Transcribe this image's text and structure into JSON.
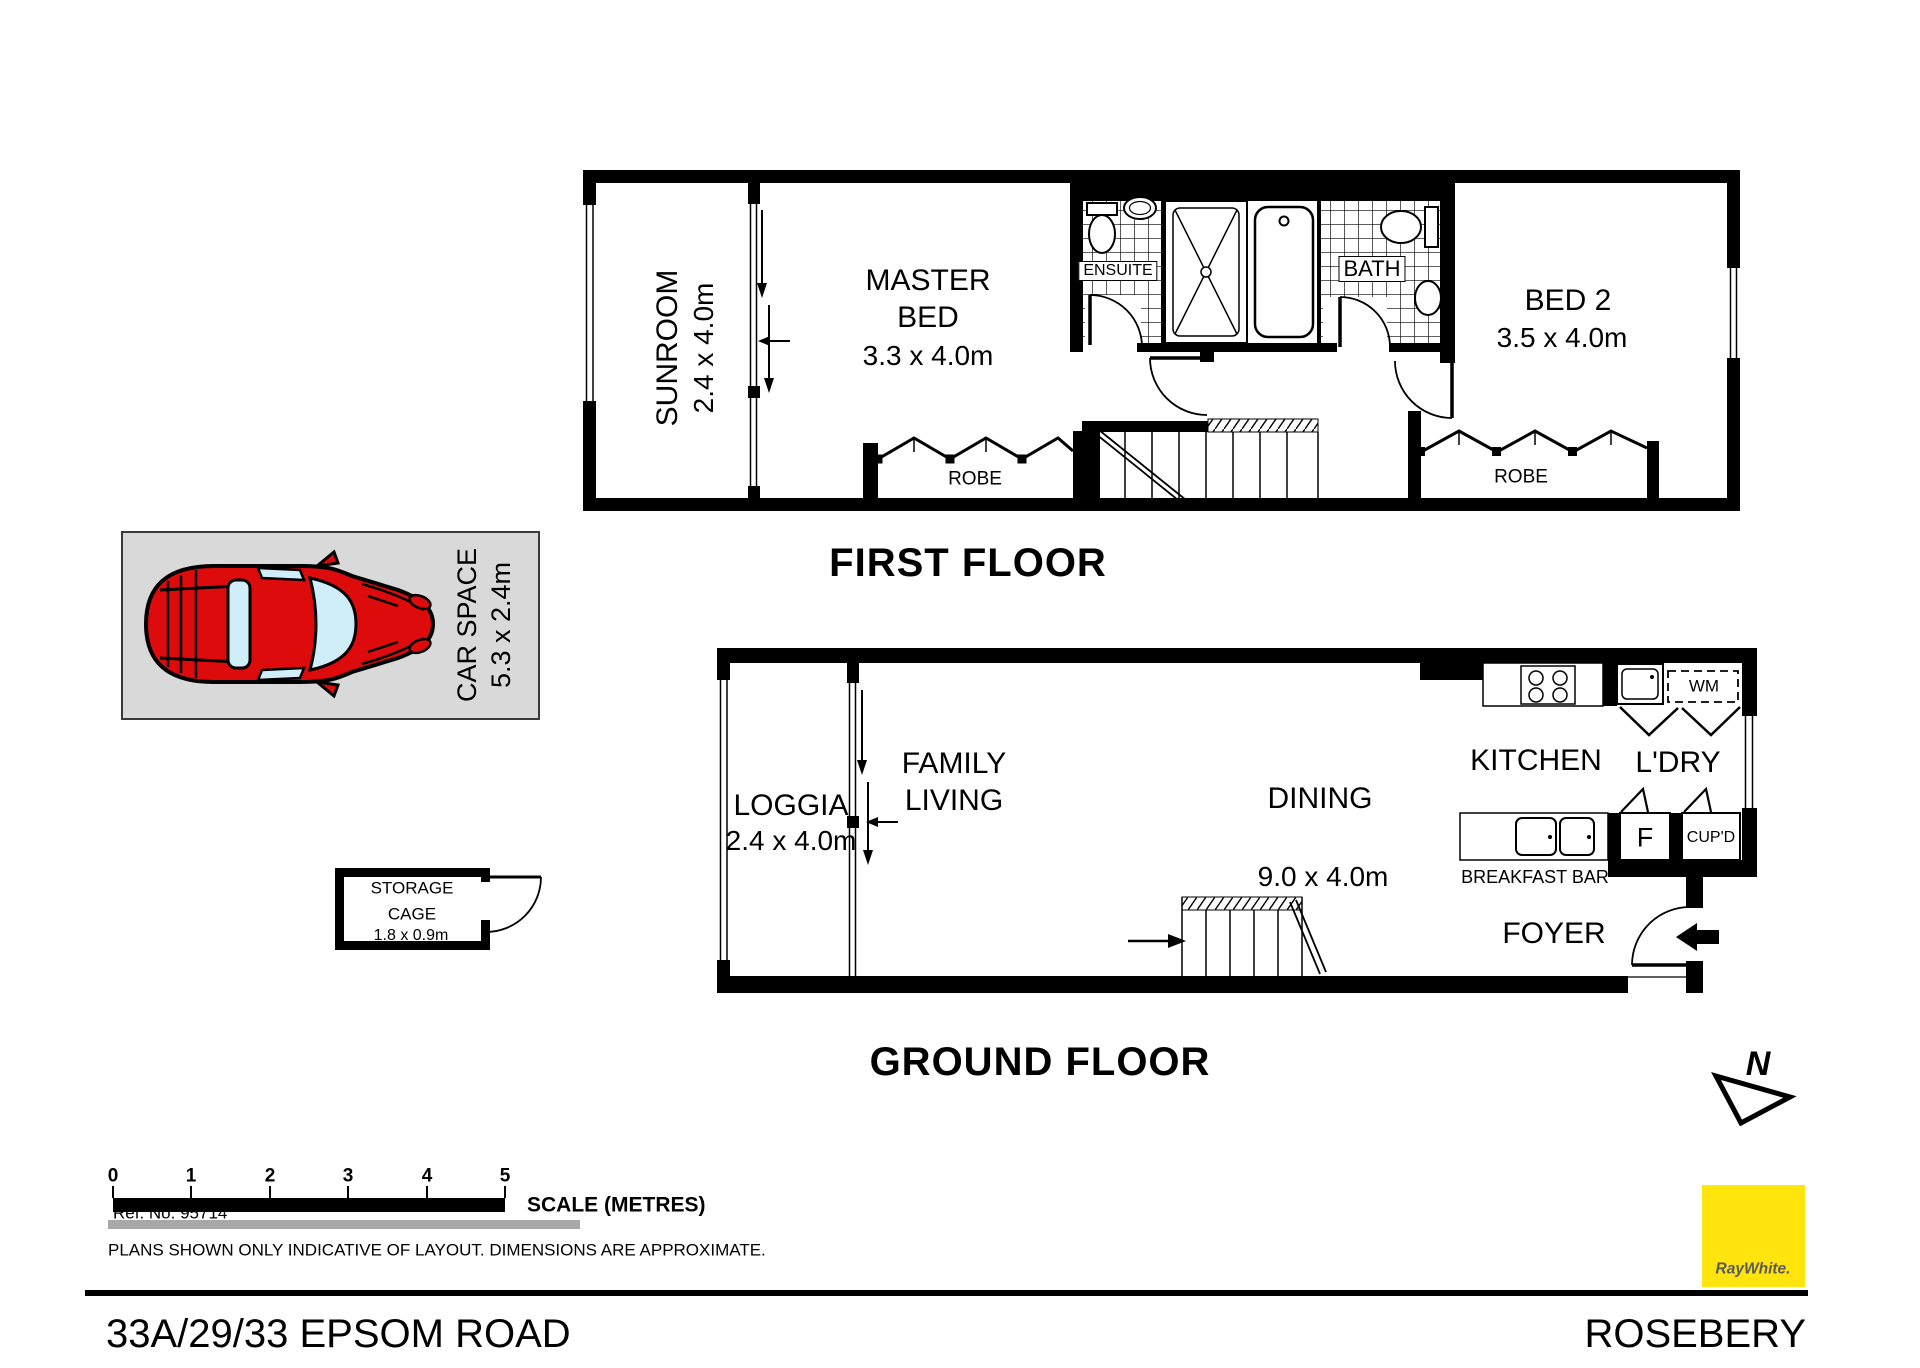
{
  "first_floor": {
    "title": "FIRST FLOOR",
    "sunroom": {
      "name": "SUNROOM",
      "dims": "2.4 x 4.0m"
    },
    "master_bed": {
      "line1": "MASTER",
      "line2": "BED",
      "dims": "3.3 x 4.0m"
    },
    "ensuite": "ENSUITE",
    "bath": "BATH",
    "bed2": {
      "name": "BED 2",
      "dims": "3.5 x 4.0m"
    },
    "robe_master": "ROBE",
    "robe_bed2": "ROBE"
  },
  "ground_floor": {
    "title": "GROUND FLOOR",
    "loggia": {
      "name": "LOGGIA",
      "dims": "2.4 x 4.0m"
    },
    "family_living": {
      "line1": "FAMILY",
      "line2": "LIVING"
    },
    "dining": {
      "name": "DINING",
      "dims": "9.0 x 4.0m"
    },
    "kitchen": "KITCHEN",
    "laundry": "L'DRY",
    "washing_machine": "WM",
    "fridge": "F",
    "cupboard": "CUP'D",
    "breakfast_bar": "BREAKFAST BAR",
    "foyer": "FOYER"
  },
  "car_space": {
    "name": "CAR SPACE",
    "dims": "5.3 x 2.4m"
  },
  "storage_cage": {
    "line1": "STORAGE",
    "line2": "CAGE",
    "dims": "1.8 x 0.9m"
  },
  "north": {
    "label": "N"
  },
  "scale_bar": {
    "ticks": [
      "0",
      "1",
      "2",
      "3",
      "4",
      "5"
    ],
    "label": "SCALE (METRES)"
  },
  "footer": {
    "ref": "Ref. No. 95714",
    "disclaimer": "PLANS SHOWN ONLY INDICATIVE OF LAYOUT.  DIMENSIONS ARE APPROXIMATE.",
    "address": "33A/29/33 EPSOM ROAD",
    "suburb": "ROSEBERY"
  },
  "brand": {
    "name": "RayWhite."
  },
  "colors": {
    "wall": "#000000",
    "car_red": "#dd0b0b",
    "glass_blue": "#cfeef9",
    "car_space_bg": "#d9d9d9",
    "brand_yellow": "#ffe40d",
    "gray_bar": "#a8a8a8"
  }
}
